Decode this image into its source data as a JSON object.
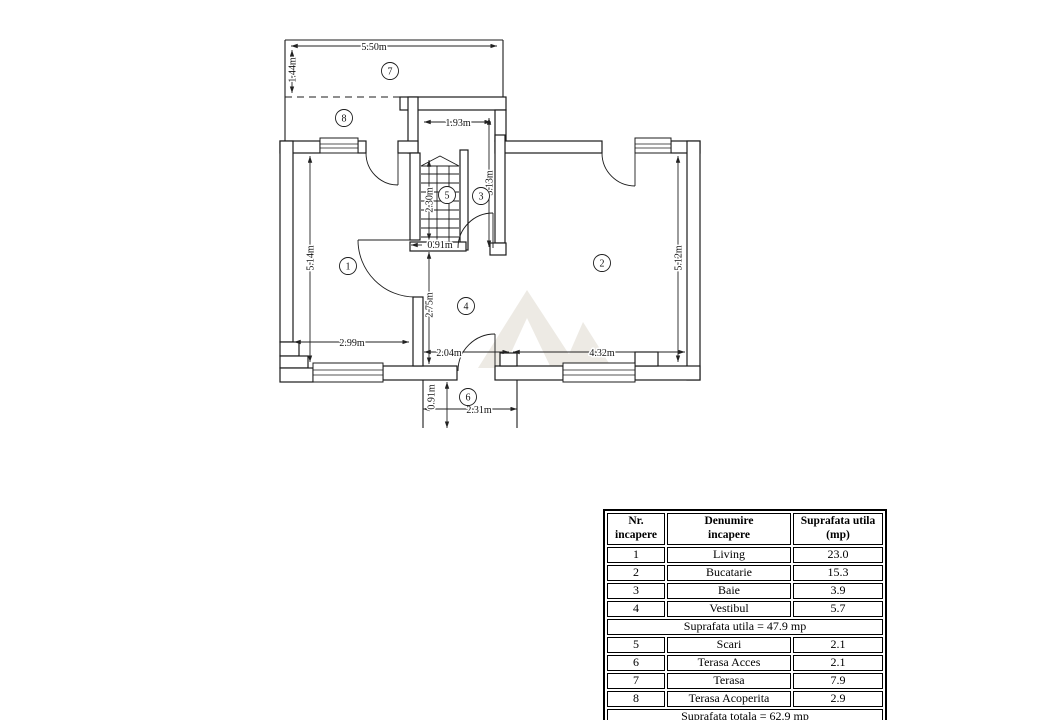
{
  "plan": {
    "rooms": {
      "r1": "1",
      "r2": "2",
      "r3": "3",
      "r4": "4",
      "r5": "5",
      "r6": "6",
      "r7": "7",
      "r8": "8"
    },
    "dims": {
      "terasa_width": "5.50m",
      "terasa_depth": "1.44m",
      "landing_width": "1.93m",
      "baie_depth": "3.13m",
      "scari_depth": "2.30m",
      "scari_width": "0.91m",
      "living_depth": "5.14m",
      "living_width": "2.99m",
      "vestibul_depth": "2.75m",
      "vestibul_width": "2.04m",
      "bucatarie_width": "4.32m",
      "bucatarie_depth": "5.12m",
      "acces_depth": "0.91m",
      "acces_width": "2.31m"
    }
  },
  "table": {
    "headers": {
      "col1": "Nr.\nincapere",
      "col2": "Denumire\nincapere",
      "col3": "Suprafata utila\n(mp)"
    },
    "rows": [
      {
        "nr": "1",
        "name": "Living",
        "area": "23.0"
      },
      {
        "nr": "2",
        "name": "Bucatarie",
        "area": "15.3"
      },
      {
        "nr": "3",
        "name": "Baie",
        "area": "3.9"
      },
      {
        "nr": "4",
        "name": "Vestibul",
        "area": "5.7"
      },
      {
        "nr": "5",
        "name": "Scari",
        "area": "2.1"
      },
      {
        "nr": "6",
        "name": "Terasa Acces",
        "area": "2.1"
      },
      {
        "nr": "7",
        "name": "Terasa",
        "area": "7.9"
      },
      {
        "nr": "8",
        "name": "Terasa Acoperita",
        "area": "2.9"
      }
    ],
    "subtotal": "Suprafata utila = 47.9 mp",
    "total": "Suprafata totala = 62.9 mp"
  }
}
